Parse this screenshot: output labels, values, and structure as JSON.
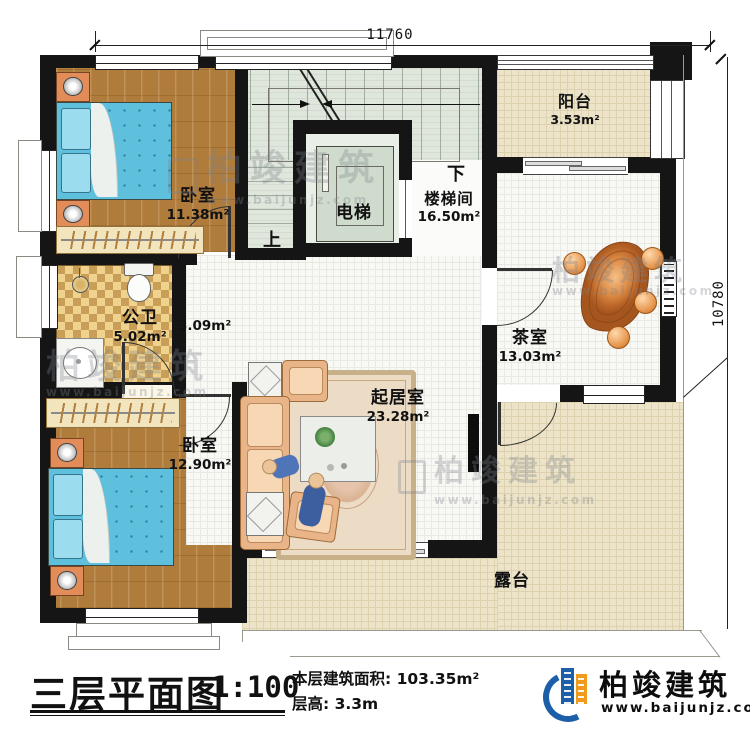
{
  "dimensions": {
    "width": "11760",
    "height": "10780"
  },
  "rooms": {
    "bedroom_top": {
      "name": "卧室",
      "area": "11.38m²"
    },
    "bedroom_bottom": {
      "name": "卧室",
      "area": "12.90m²"
    },
    "bathroom": {
      "name": "公卫",
      "area": "5.02m²"
    },
    "hallway": {
      "area": "3.09m²"
    },
    "living_room": {
      "name": "起居室",
      "area": "23.28m²"
    },
    "tea_room": {
      "name": "茶室",
      "area": "13.03m²"
    },
    "balcony": {
      "name": "阳台",
      "area": "3.53m²"
    },
    "stairwell": {
      "name": "楼梯间",
      "area": "16.50m²"
    },
    "elevator": {
      "name": "电梯"
    },
    "terrace": {
      "name": "露台"
    }
  },
  "stairs": {
    "up_label": "上",
    "down_label": "下"
  },
  "title_block": {
    "title": "三层平面图",
    "scale": "1:100",
    "area_label": "本层建筑面积: 103.35m²",
    "floor_height_label": "层高: 3.3m"
  },
  "brand": {
    "name": "柏竣建筑",
    "website": "www.baijunjz.com"
  },
  "colors": {
    "wall": "#151515",
    "wood_floor": "#b07c3b",
    "bed": "#5fc0dd",
    "bath_tile": "#e7c77f",
    "stair_floor": "#dfe6db",
    "terrace_floor": "#ece3c8",
    "tea_table": "#d98640",
    "brand_blue": "#1c5ea8",
    "brand_orange": "#f09b1d"
  }
}
